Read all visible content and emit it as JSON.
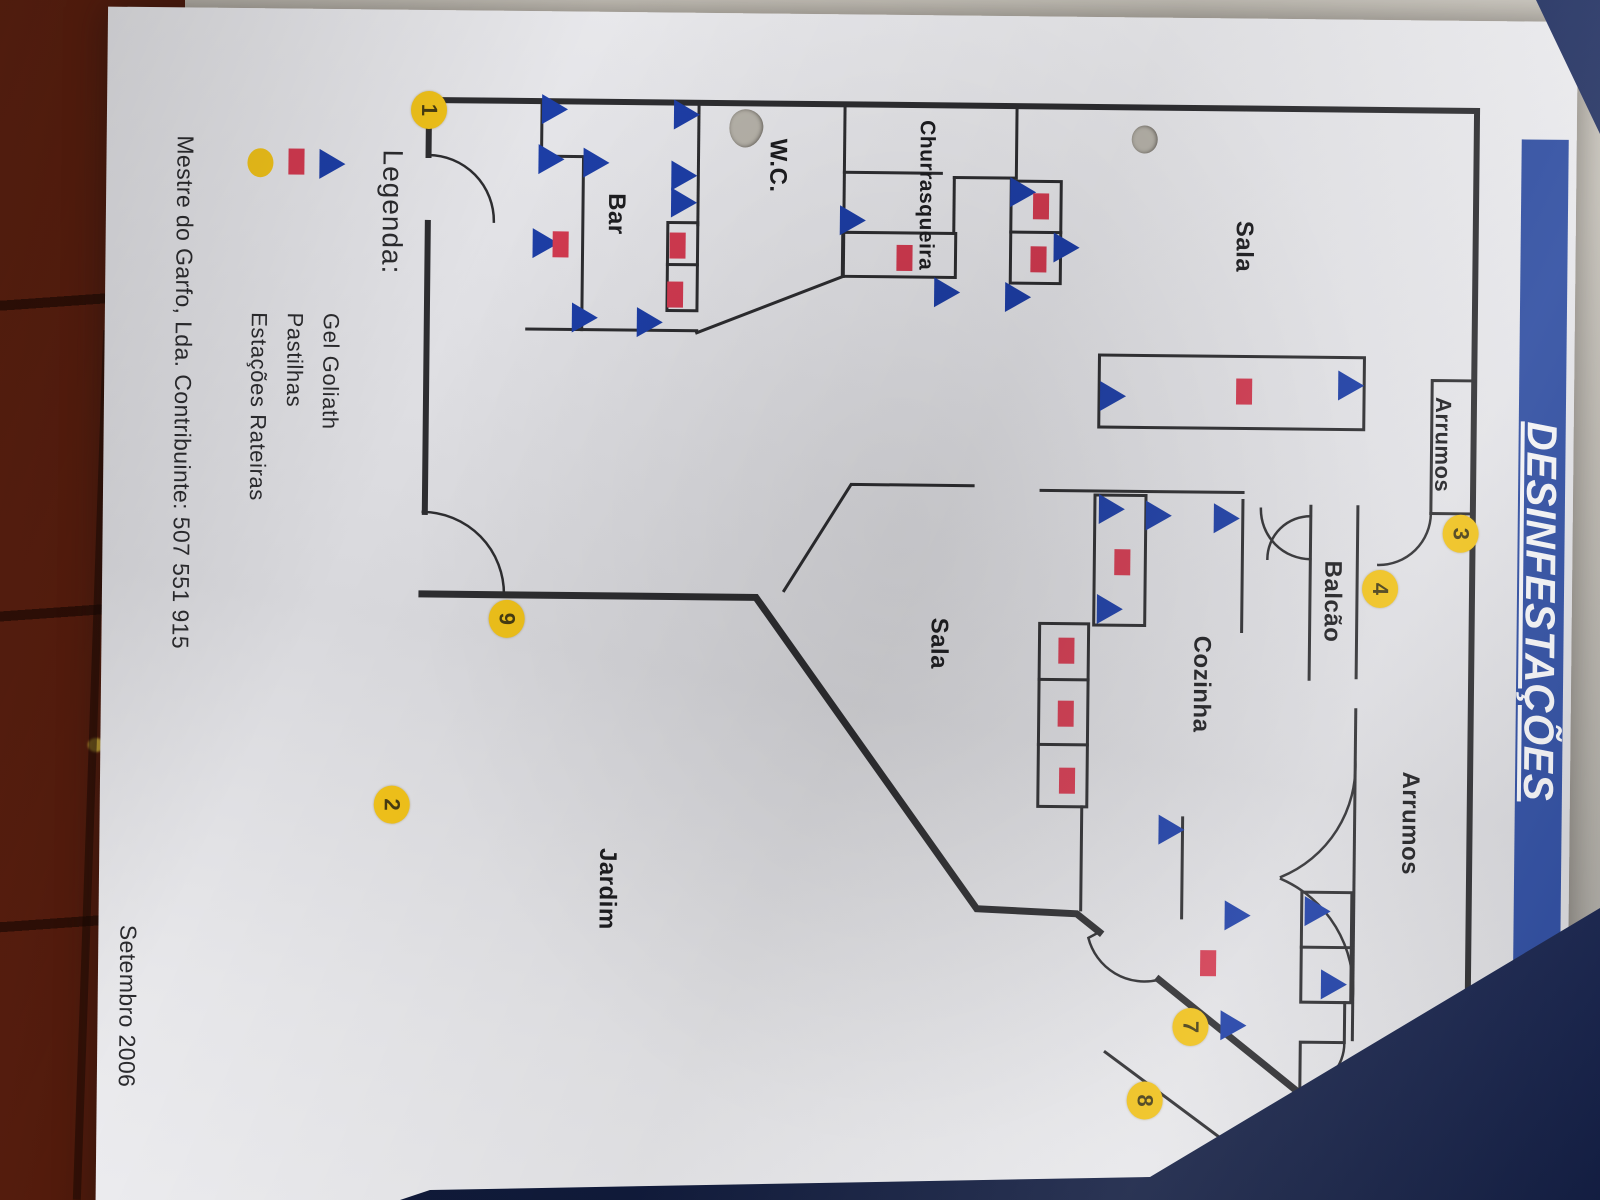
{
  "document": {
    "title": "DESINFESTAÇÕES",
    "footer_company": "Mestre do Garfo, Lda. Contribuinte: 507 551 915",
    "footer_date": "Setembro 2006"
  },
  "colors": {
    "banner_blue": "#2c4ba0",
    "marker_blue": "#1d3ea6",
    "marker_red": "#d23a50",
    "marker_yellow": "#efc11a",
    "wall": "#2d2d30"
  },
  "legend": {
    "heading": "Legenda:",
    "items": [
      {
        "icon": "triangle",
        "label": "Gel Goliath"
      },
      {
        "icon": "square",
        "label": "Pastilhas"
      },
      {
        "icon": "circle",
        "label": "Estações Rateiras"
      }
    ]
  },
  "rooms": [
    {
      "id": "sala-1",
      "label": "Sala",
      "x": 228,
      "y": 332,
      "fs": 24
    },
    {
      "id": "arrumos-1",
      "label": "Arrumos",
      "x": 424,
      "y": 131,
      "fs": 22
    },
    {
      "id": "balcao",
      "label": "Balcão",
      "x": 582,
      "y": 240,
      "fs": 24
    },
    {
      "id": "cozinha",
      "label": "Cozinha",
      "x": 666,
      "y": 370,
      "fs": 24
    },
    {
      "id": "arrumos-2",
      "label": "Arrumos",
      "x": 803,
      "y": 160,
      "fs": 24
    },
    {
      "id": "sala-2",
      "label": "Sala",
      "x": 628,
      "y": 633,
      "fs": 24
    },
    {
      "id": "jardim",
      "label": "Jardim",
      "x": 877,
      "y": 962,
      "fs": 24
    },
    {
      "id": "wc",
      "label": "W.C.",
      "x": 152,
      "y": 799,
      "fs": 24
    },
    {
      "id": "churrasqueira",
      "label": "Churrasqueira",
      "x": 180,
      "y": 650,
      "fs": 21
    },
    {
      "id": "bar",
      "label": "Bar",
      "x": 202,
      "y": 960,
      "fs": 24
    }
  ],
  "markers": {
    "gel_goliath": [
      [
        98,
        1022
      ],
      [
        148,
        1025
      ],
      [
        151,
        980
      ],
      [
        232,
        1030
      ],
      [
        306,
        990
      ],
      [
        310,
        925
      ],
      [
        102,
        890
      ],
      [
        163,
        892
      ],
      [
        190,
        892
      ],
      [
        206,
        723
      ],
      [
        277,
        628
      ],
      [
        176,
        553
      ],
      [
        231,
        509
      ],
      [
        281,
        557
      ],
      [
        366,
        223
      ],
      [
        379,
        461
      ],
      [
        492,
        461
      ],
      [
        498,
        414
      ],
      [
        592,
        462
      ],
      [
        500,
        346
      ],
      [
        812,
        398
      ],
      [
        897,
        331
      ],
      [
        1007,
        334
      ],
      [
        892,
        251
      ],
      [
        965,
        234
      ]
    ],
    "pastilhas": [
      [
        233,
        898
      ],
      [
        282,
        900
      ],
      [
        233,
        1015
      ],
      [
        243,
        671
      ],
      [
        190,
        535
      ],
      [
        243,
        537
      ],
      [
        373,
        330
      ],
      [
        545,
        450
      ],
      [
        634,
        505
      ],
      [
        697,
        505
      ],
      [
        764,
        503
      ],
      [
        945,
        360
      ]
    ],
    "stations": [
      {
        "n": "1",
        "x": 100,
        "y": 1148
      },
      {
        "n": "2",
        "x": 795,
        "y": 1178
      },
      {
        "n": "3",
        "x": 513,
        "y": 112
      },
      {
        "n": "4",
        "x": 569,
        "y": 192
      },
      {
        "n": "5",
        "x": 1104,
        "y": 200
      },
      {
        "n": "6",
        "x": 1101,
        "y": 268
      },
      {
        "n": "7",
        "x": 1009,
        "y": 377
      },
      {
        "n": "8",
        "x": 1083,
        "y": 422
      },
      {
        "n": "9",
        "x": 608,
        "y": 1065
      }
    ]
  }
}
